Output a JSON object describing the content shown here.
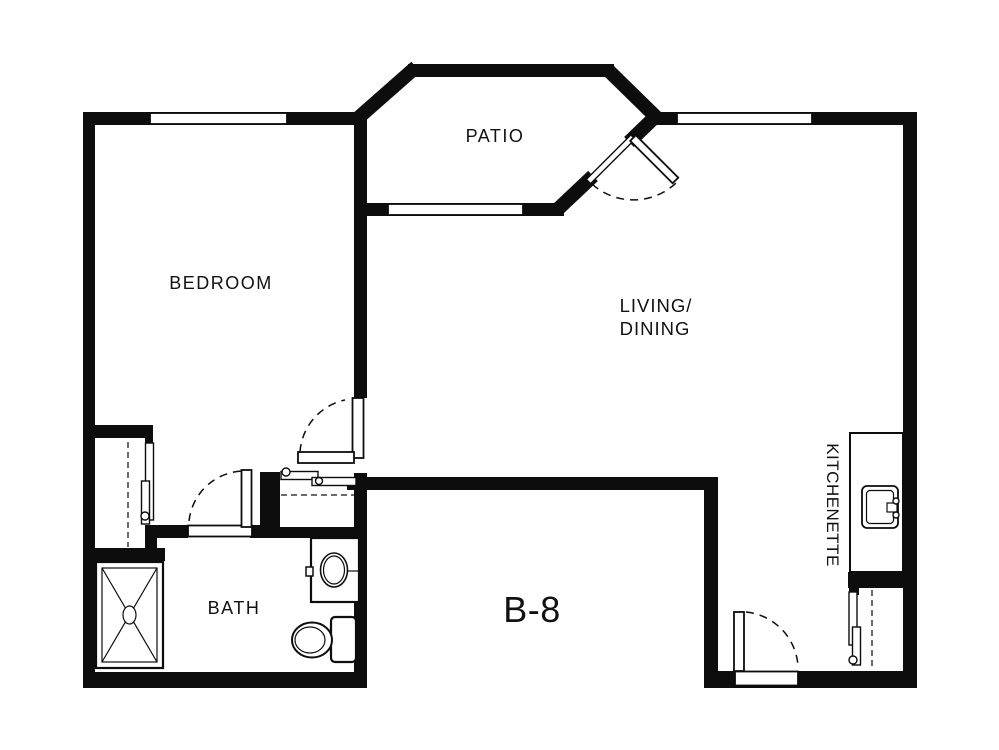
{
  "plan": {
    "unit_label": "B-8",
    "rooms": {
      "bedroom": "BEDROOM",
      "patio": "PATIO",
      "living_line1": "LIVING/",
      "living_line2": "DINING",
      "bath": "BATH",
      "kitchenette": "KITCHENETTE"
    },
    "colors": {
      "wall": "#0d0d0d",
      "background": "#ffffff"
    },
    "fixture_icons": [
      "shower-icon",
      "toilet-icon",
      "vanity-sink-icon",
      "kitchen-sink-icon",
      "closet-rod-icon",
      "door-swing-icon",
      "window-icon"
    ]
  }
}
